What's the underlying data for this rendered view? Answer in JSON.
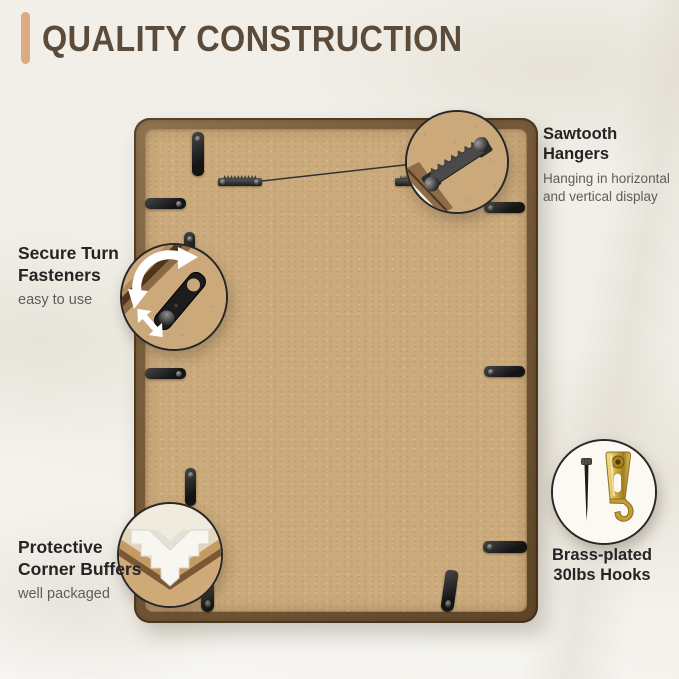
{
  "header": {
    "title": "QUALITY CONSTRUCTION"
  },
  "callouts": {
    "sawtooth_hangers": {
      "title": "Sawtooth Hangers",
      "description_line1": "Hanging in horizontal",
      "description_line2": "and vertical display"
    },
    "turn_fasteners": {
      "title_line1": "Secure Turn",
      "title_line2": "Fasteners",
      "description": "easy to use"
    },
    "corner_buffers": {
      "title_line1": "Protective",
      "title_line2": "Corner Buffers",
      "description": "well packaged"
    },
    "brass_hooks": {
      "title_line1": "Brass-plated",
      "title_line2": "30lbs Hooks"
    }
  },
  "icons": {
    "sawtooth_bubble": "sawtooth-hanger-zoom",
    "turn_bubble": "turn-fastener-zoom",
    "buffer_bubble": "corner-buffer-zoom",
    "brass_bubble": "brass-hook-and-nail"
  },
  "colors": {
    "background": "#f1efe8",
    "accent_bar": "#dcab84",
    "title_text": "#5d4b39",
    "mdf_backing": "#cbaa7c",
    "frame_wood": "#6c5132",
    "hardware_black": "#1a1a1a",
    "brass": "#d9b74a",
    "callout_title": "#242424",
    "callout_subtitle": "#5d5d5d"
  }
}
